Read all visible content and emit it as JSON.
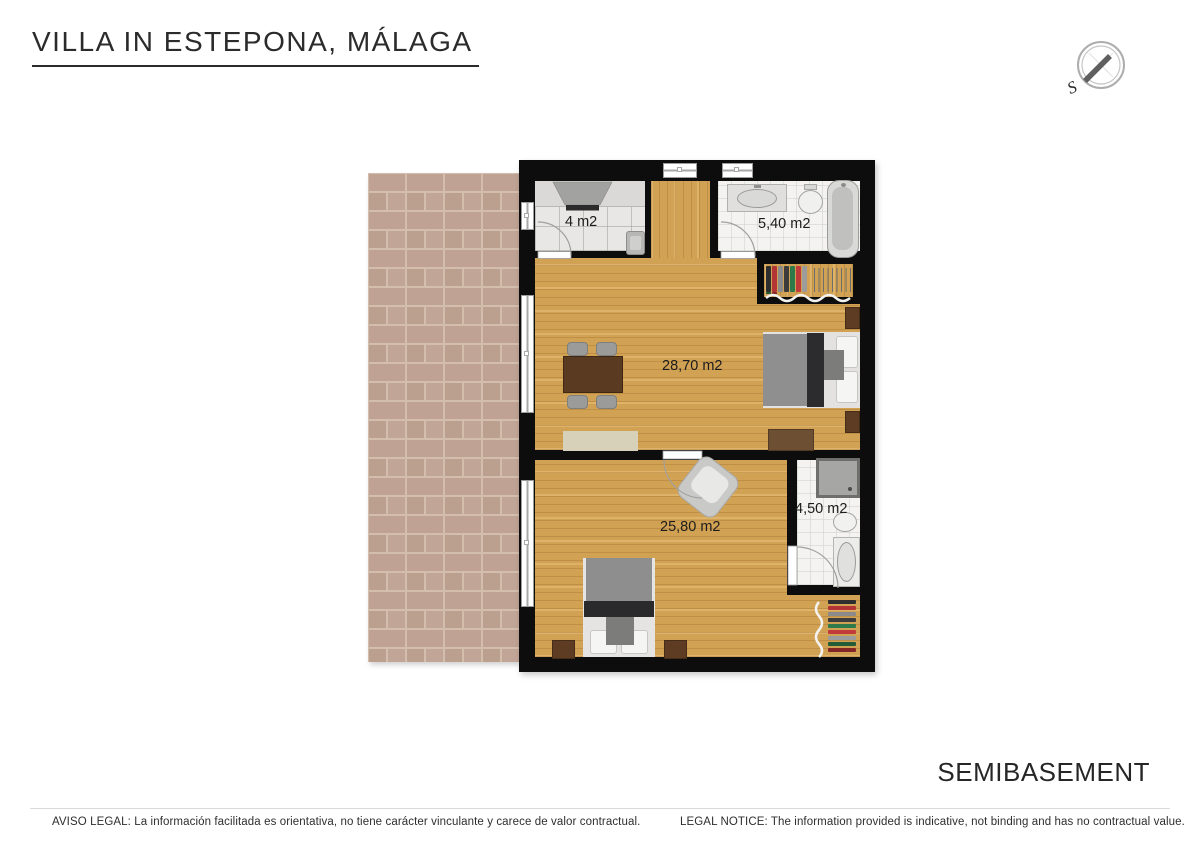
{
  "header": {
    "title": "VILLA IN ESTEPONA, MÁLAGA"
  },
  "compass": {
    "label": "S"
  },
  "plan": {
    "rooms": [
      {
        "id": "kitchen",
        "area_label": "4 m2"
      },
      {
        "id": "bathroom-top",
        "area_label": "5,40 m2"
      },
      {
        "id": "living-dining",
        "area_label": "28,70 m2"
      },
      {
        "id": "bedroom",
        "area_label": "25,80 m2"
      },
      {
        "id": "bathroom-bottom",
        "area_label": "4,50 m2"
      }
    ]
  },
  "floor": {
    "label": "SEMIBASEMENT"
  },
  "footer": {
    "aviso_legal": "AVISO LEGAL: La información facilitada es orientativa, no tiene carácter vinculante y carece de valor contractual.",
    "legal_notice": "LEGAL NOTICE: The information provided is indicative, not binding and has no contractual value."
  },
  "colors": {
    "wall": "#0d0d0d",
    "wood_floor": "#d2a254",
    "brick": "#bfa294",
    "brick_mortar": "#d3bdac",
    "tile_gray": "#e8e7e5",
    "tile_white": "#f4f3f1"
  },
  "decor": {
    "wardrobe_item_colors": [
      "#2e2e2e",
      "#b23434",
      "#8b8b8b",
      "#3c3c3c",
      "#2f7a4a",
      "#c13b3b",
      "#9c9c9c",
      "#245c38",
      "#842626"
    ]
  }
}
